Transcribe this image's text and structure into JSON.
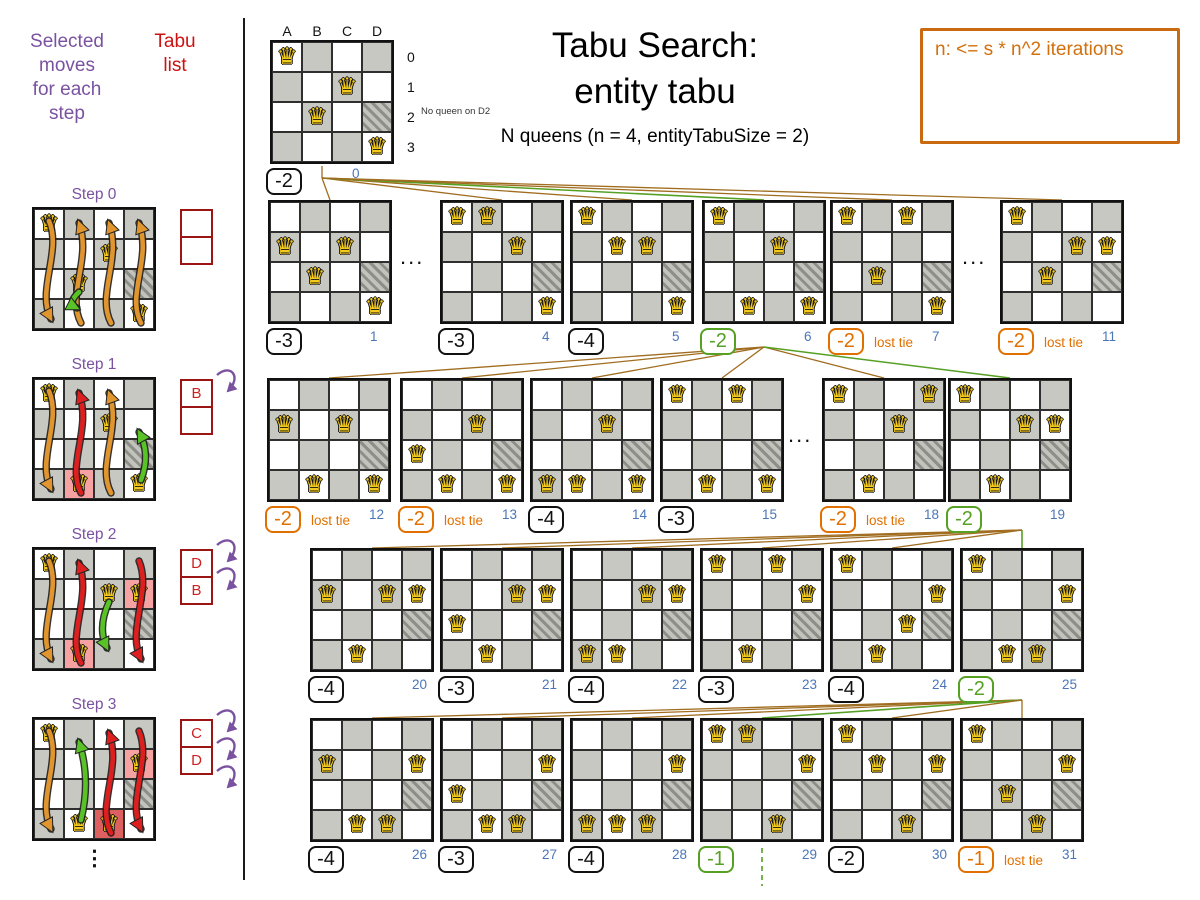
{
  "header": {
    "title_line1": "Tabu Search:",
    "title_line2": "entity tabu",
    "subtitle": "N queens (n = 4, entityTabuSize = 2)",
    "info_note": "n: <= s * n^2 iterations"
  },
  "left_panel": {
    "moves_header": "Selected\nmoves\nfor each\nstep",
    "tabu_header": "Tabu\nlist",
    "continuation_ellipsis": "⋮",
    "steps": [
      {
        "label": "Step 0",
        "queens": [
          "A0",
          "C1",
          "B2",
          "D3"
        ],
        "highlights": [],
        "arrows": [
          {
            "column": "A",
            "state": "candidate"
          },
          {
            "column": "B",
            "state": "candidate"
          },
          {
            "column": "C",
            "state": "candidate"
          },
          {
            "column": "D",
            "state": "candidate"
          },
          {
            "column": "B",
            "state": "selected",
            "move": "B2-B3"
          }
        ],
        "tabu_list": [
          "",
          ""
        ],
        "incoming_arrows": 0
      },
      {
        "label": "Step 1",
        "queens": [
          "A0",
          "C1",
          "B3",
          "D3"
        ],
        "highlights": [
          {
            "cell": "B3",
            "color": "pink"
          }
        ],
        "arrows": [
          {
            "column": "A",
            "state": "candidate"
          },
          {
            "column": "B",
            "state": "tabu"
          },
          {
            "column": "C",
            "state": "candidate"
          },
          {
            "column": "D",
            "state": "selected",
            "move": "D3-D1"
          }
        ],
        "tabu_list": [
          "B",
          ""
        ],
        "incoming_arrows": 1
      },
      {
        "label": "Step 2",
        "queens": [
          "A0",
          "C1",
          "B3",
          "D1"
        ],
        "highlights": [
          {
            "cell": "B3",
            "color": "pink"
          },
          {
            "cell": "D1",
            "color": "pink"
          }
        ],
        "arrows": [
          {
            "column": "A",
            "state": "candidate"
          },
          {
            "column": "B",
            "state": "tabu"
          },
          {
            "column": "C",
            "state": "selected",
            "move": "C1-C3"
          },
          {
            "column": "D",
            "state": "tabu"
          }
        ],
        "tabu_list": [
          "D",
          "B"
        ],
        "incoming_arrows": 2
      },
      {
        "label": "Step 3",
        "queens": [
          "A0",
          "D1",
          "B3",
          "C3"
        ],
        "highlights": [
          {
            "cell": "D1",
            "color": "pink"
          },
          {
            "cell": "C3",
            "color": "red"
          }
        ],
        "arrows": [
          {
            "column": "A",
            "state": "candidate"
          },
          {
            "column": "B",
            "state": "selected",
            "move": "B3-B0"
          },
          {
            "column": "C",
            "state": "tabu"
          },
          {
            "column": "D",
            "state": "tabu"
          }
        ],
        "tabu_list": [
          "C",
          "D"
        ],
        "incoming_arrows": 3
      }
    ]
  },
  "root": {
    "column_labels": [
      "A",
      "B",
      "C",
      "D"
    ],
    "row_labels": [
      "0",
      "1",
      "2",
      "3"
    ],
    "queens": [
      "A0",
      "C1",
      "B2",
      "D3"
    ],
    "blocked_cell": "D2",
    "annotation": "No queen on D2",
    "score": "-2",
    "index": "0"
  },
  "lost_tie_label": "lost tie",
  "row_ellipsis": "...",
  "tree_rows": [
    {
      "boards": [
        {
          "index": "1",
          "score": "-3",
          "state": "normal",
          "queens": [
            "A1",
            "C1",
            "B2",
            "D3"
          ]
        },
        {
          "ellipsis": true
        },
        {
          "index": "4",
          "score": "-3",
          "state": "normal",
          "queens": [
            "A0",
            "B0",
            "C1",
            "D3"
          ]
        },
        {
          "index": "5",
          "score": "-4",
          "state": "normal",
          "queens": [
            "A0",
            "B1",
            "C1",
            "D3"
          ]
        },
        {
          "index": "6",
          "score": "-2",
          "state": "selected",
          "queens": [
            "A0",
            "C1",
            "B3",
            "D3"
          ]
        },
        {
          "index": "7",
          "score": "-2",
          "state": "lost_tie",
          "queens": [
            "A0",
            "C0",
            "B2",
            "D3"
          ]
        },
        {
          "ellipsis": true
        },
        {
          "index": "11",
          "score": "-2",
          "state": "lost_tie",
          "queens": [
            "A0",
            "C1",
            "D1",
            "B2"
          ]
        }
      ]
    },
    {
      "boards": [
        {
          "index": "12",
          "score": "-2",
          "state": "lost_tie",
          "queens": [
            "A1",
            "C1",
            "B3",
            "D3"
          ]
        },
        {
          "index": "13",
          "score": "-2",
          "state": "lost_tie",
          "queens": [
            "A2",
            "C1",
            "B3",
            "D3"
          ]
        },
        {
          "index": "14",
          "score": "-4",
          "state": "normal",
          "queens": [
            "A3",
            "C1",
            "B3",
            "D3"
          ]
        },
        {
          "index": "15",
          "score": "-3",
          "state": "normal",
          "queens": [
            "A0",
            "C0",
            "B3",
            "D3"
          ]
        },
        {
          "ellipsis": true
        },
        {
          "index": "18",
          "score": "-2",
          "state": "lost_tie",
          "queens": [
            "A0",
            "D0",
            "C1",
            "B3"
          ]
        },
        {
          "index": "19",
          "score": "-2",
          "state": "selected",
          "queens": [
            "A0",
            "C1",
            "D1",
            "B3"
          ]
        }
      ]
    },
    {
      "boards": [
        {
          "index": "20",
          "score": "-4",
          "state": "normal",
          "queens": [
            "A1",
            "C1",
            "D1",
            "B3"
          ]
        },
        {
          "index": "21",
          "score": "-3",
          "state": "normal",
          "queens": [
            "A2",
            "C1",
            "D1",
            "B3"
          ]
        },
        {
          "index": "22",
          "score": "-4",
          "state": "normal",
          "queens": [
            "A3",
            "C1",
            "D1",
            "B3"
          ]
        },
        {
          "index": "23",
          "score": "-3",
          "state": "normal",
          "queens": [
            "A0",
            "C0",
            "D1",
            "B3"
          ]
        },
        {
          "index": "24",
          "score": "-4",
          "state": "normal",
          "queens": [
            "A0",
            "C2",
            "D1",
            "B3"
          ]
        },
        {
          "index": "25",
          "score": "-2",
          "state": "selected",
          "queens": [
            "A0",
            "D1",
            "B3",
            "C3"
          ]
        }
      ]
    },
    {
      "boards": [
        {
          "index": "26",
          "score": "-4",
          "state": "normal",
          "queens": [
            "A1",
            "D1",
            "B3",
            "C3"
          ]
        },
        {
          "index": "27",
          "score": "-3",
          "state": "normal",
          "queens": [
            "A2",
            "D1",
            "B3",
            "C3"
          ]
        },
        {
          "index": "28",
          "score": "-4",
          "state": "normal",
          "queens": [
            "A3",
            "D1",
            "B3",
            "C3"
          ]
        },
        {
          "index": "29",
          "score": "-1",
          "state": "selected",
          "queens": [
            "A0",
            "B0",
            "D1",
            "C3"
          ]
        },
        {
          "index": "30",
          "score": "-2",
          "state": "normal",
          "queens": [
            "A0",
            "B1",
            "D1",
            "C3"
          ]
        },
        {
          "index": "31",
          "score": "-1",
          "state": "lost_tie",
          "queens": [
            "A0",
            "D1",
            "B2",
            "C3"
          ]
        }
      ]
    }
  ],
  "colors": {
    "purple": "#7a52a0",
    "tabu_red": "#cc2222",
    "tabu_border": "#9b1515",
    "orange": "#e07000",
    "info_orange": "#c96a10",
    "green": "#56a024",
    "index_blue": "#4a76b8",
    "edge_brown": "#a06d20",
    "board_gray": "#c8c8c2",
    "highlight_pink": "#f7a2a2",
    "highlight_red": "#dd6060",
    "queen_gold": "#f2c91c",
    "arrow_candidate": "#e0952f",
    "arrow_tabu": "#dd1f1f",
    "arrow_selected": "#58c226"
  }
}
